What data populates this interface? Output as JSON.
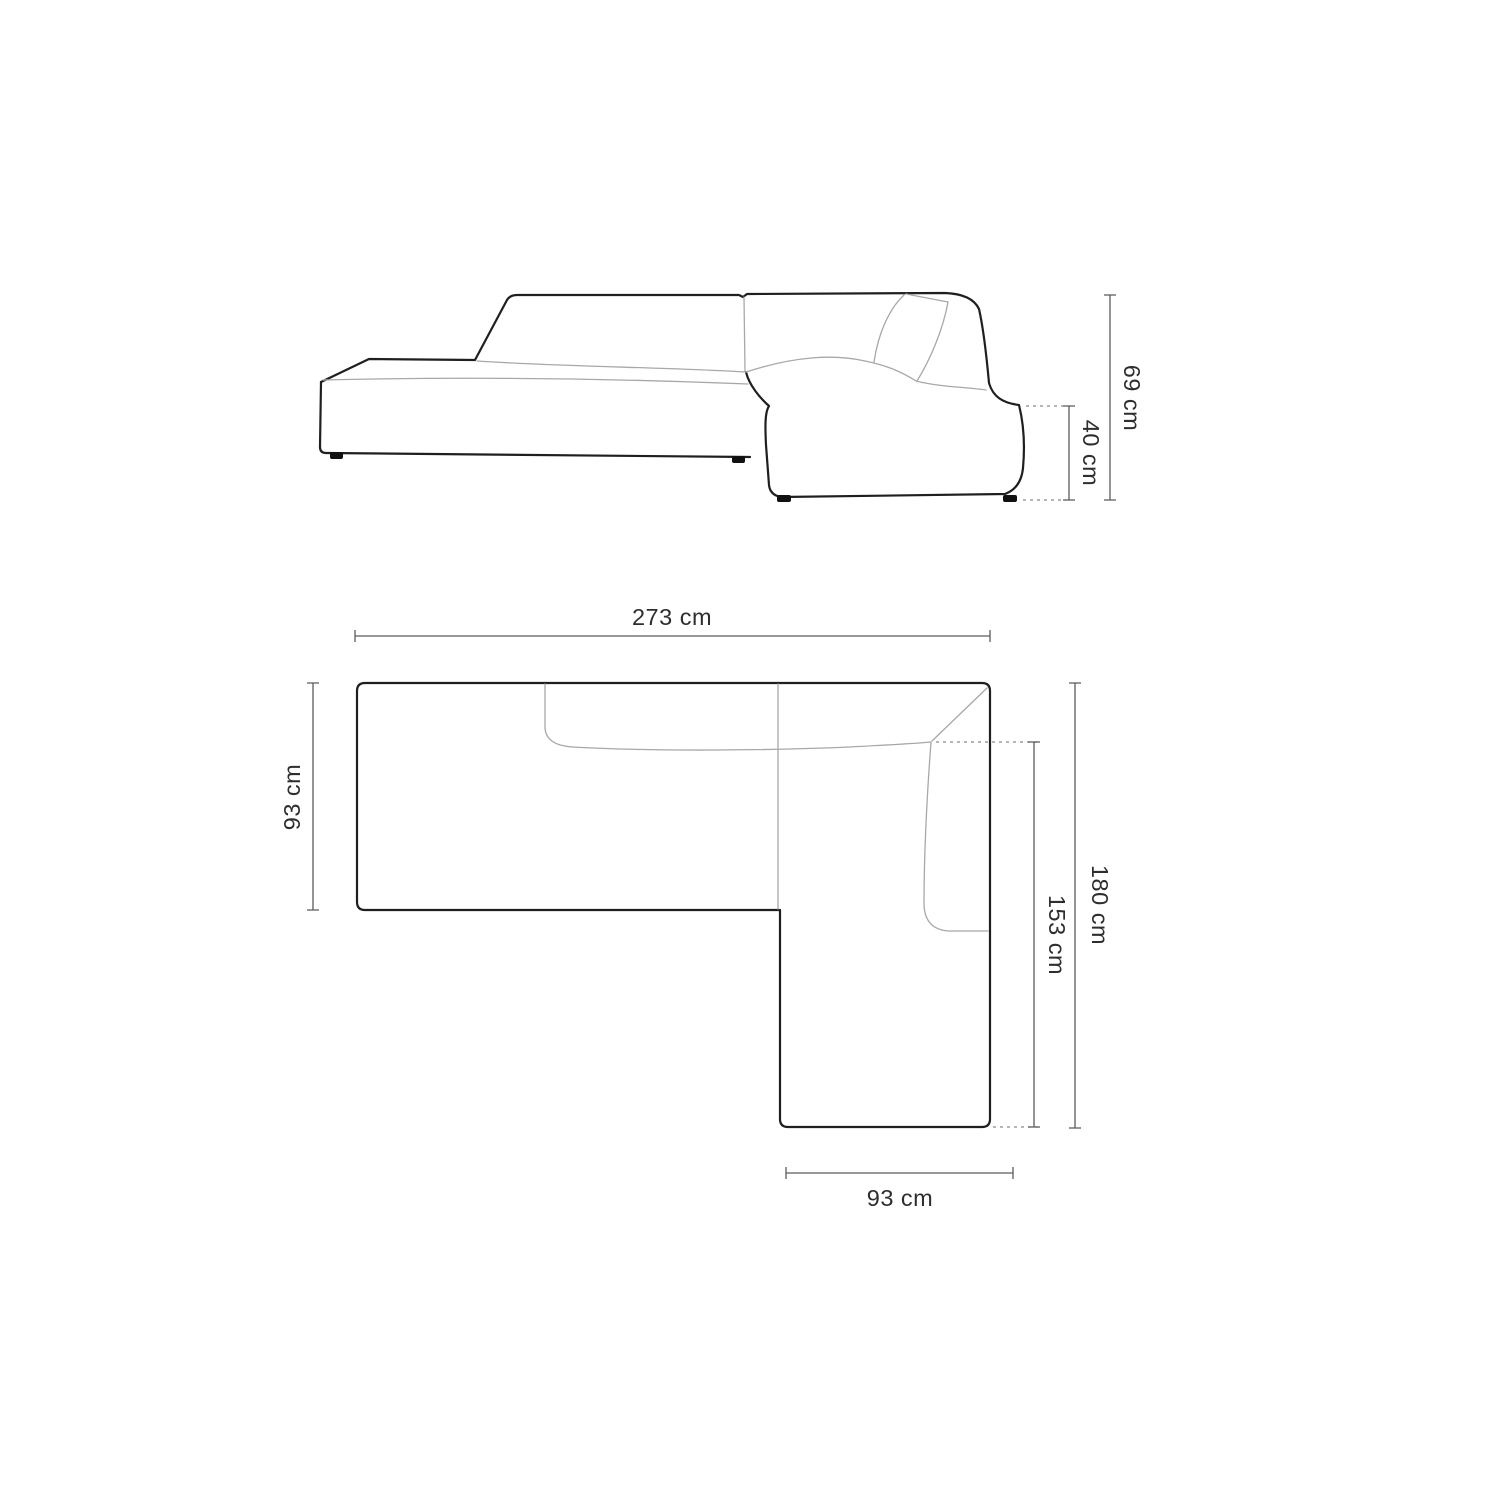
{
  "diagram": {
    "colors": {
      "background": "#ffffff",
      "outline": "#1f1f1f",
      "detail_line": "#a8a8a8",
      "dimension_line": "#5a5a5a",
      "dashed_line": "#8a8a8a",
      "label_text": "#2e2e2e"
    },
    "side_view": {
      "height_label": "69 cm",
      "seat_height_label": "40 cm"
    },
    "top_view": {
      "total_width_label": "273 cm",
      "left_depth_label": "93 cm",
      "total_depth_label": "180 cm",
      "chaise_inner_length_label": "153 cm",
      "chaise_width_label": "93 cm"
    }
  }
}
